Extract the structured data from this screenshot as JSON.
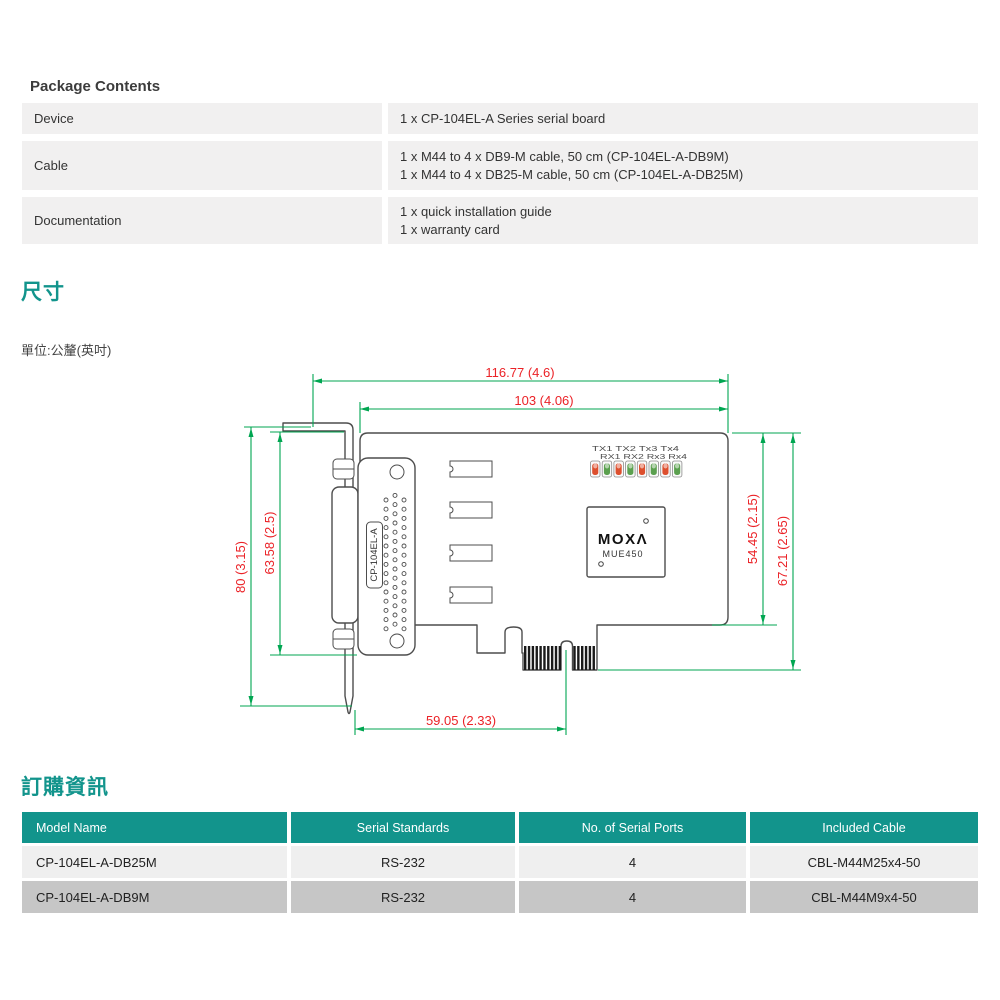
{
  "colors": {
    "teal": "#12948C",
    "package_row_bg": "#F1F0F0",
    "row_light": "#EFEFEF",
    "row_dark": "#C6C6C6",
    "dim_green": "#00A651",
    "dim_red": "#EB2227",
    "outline_gray": "#4D4D4D",
    "led_red": "#DD4F2E",
    "led_green": "#5BA04F"
  },
  "package": {
    "title": "Package Contents",
    "rows": [
      {
        "label": "Device",
        "lines": [
          "1 x CP-104EL-A Series serial board"
        ]
      },
      {
        "label": "Cable",
        "lines": [
          "1 x M44 to 4 x DB9-M cable, 50 cm (CP-104EL-A-DB9M)",
          "1 x M44 to 4 x DB25-M cable, 50 cm (CP-104EL-A-DB25M)"
        ]
      },
      {
        "label": "Documentation",
        "lines": [
          "1 x quick installation guide",
          "1 x warranty card"
        ]
      }
    ]
  },
  "dimensions_section": {
    "title": "尺寸",
    "unit_note": "單位:公釐(英吋)",
    "diagram": {
      "dim_width_total": "116.77 (4.6)",
      "dim_width_board": "103 (4.06)",
      "dim_height_bracket": "80 (3.15)",
      "dim_height_connector": "63.58 (2.5)",
      "dim_height_board": "54.45 (2.15)",
      "dim_height_total": "67.21 (2.65)",
      "dim_bottom_length": "59.05 (2.33)",
      "connector_label": "CP-104EL-A",
      "led_row1": "TX1 TX2 Tx3 Tx4",
      "led_row2": "RX1 RX2 Rx3 Rx4",
      "chip_logo": "MOXΛ",
      "chip_model": "MUE450"
    }
  },
  "ordering": {
    "title": "訂購資訊",
    "headers": [
      "Model Name",
      "Serial Standards",
      "No. of Serial Ports",
      "Included Cable"
    ],
    "rows": [
      [
        "CP-104EL-A-DB25M",
        "RS-232",
        "4",
        "CBL-M44M25x4-50"
      ],
      [
        "CP-104EL-A-DB9M",
        "RS-232",
        "4",
        "CBL-M44M9x4-50"
      ]
    ]
  }
}
